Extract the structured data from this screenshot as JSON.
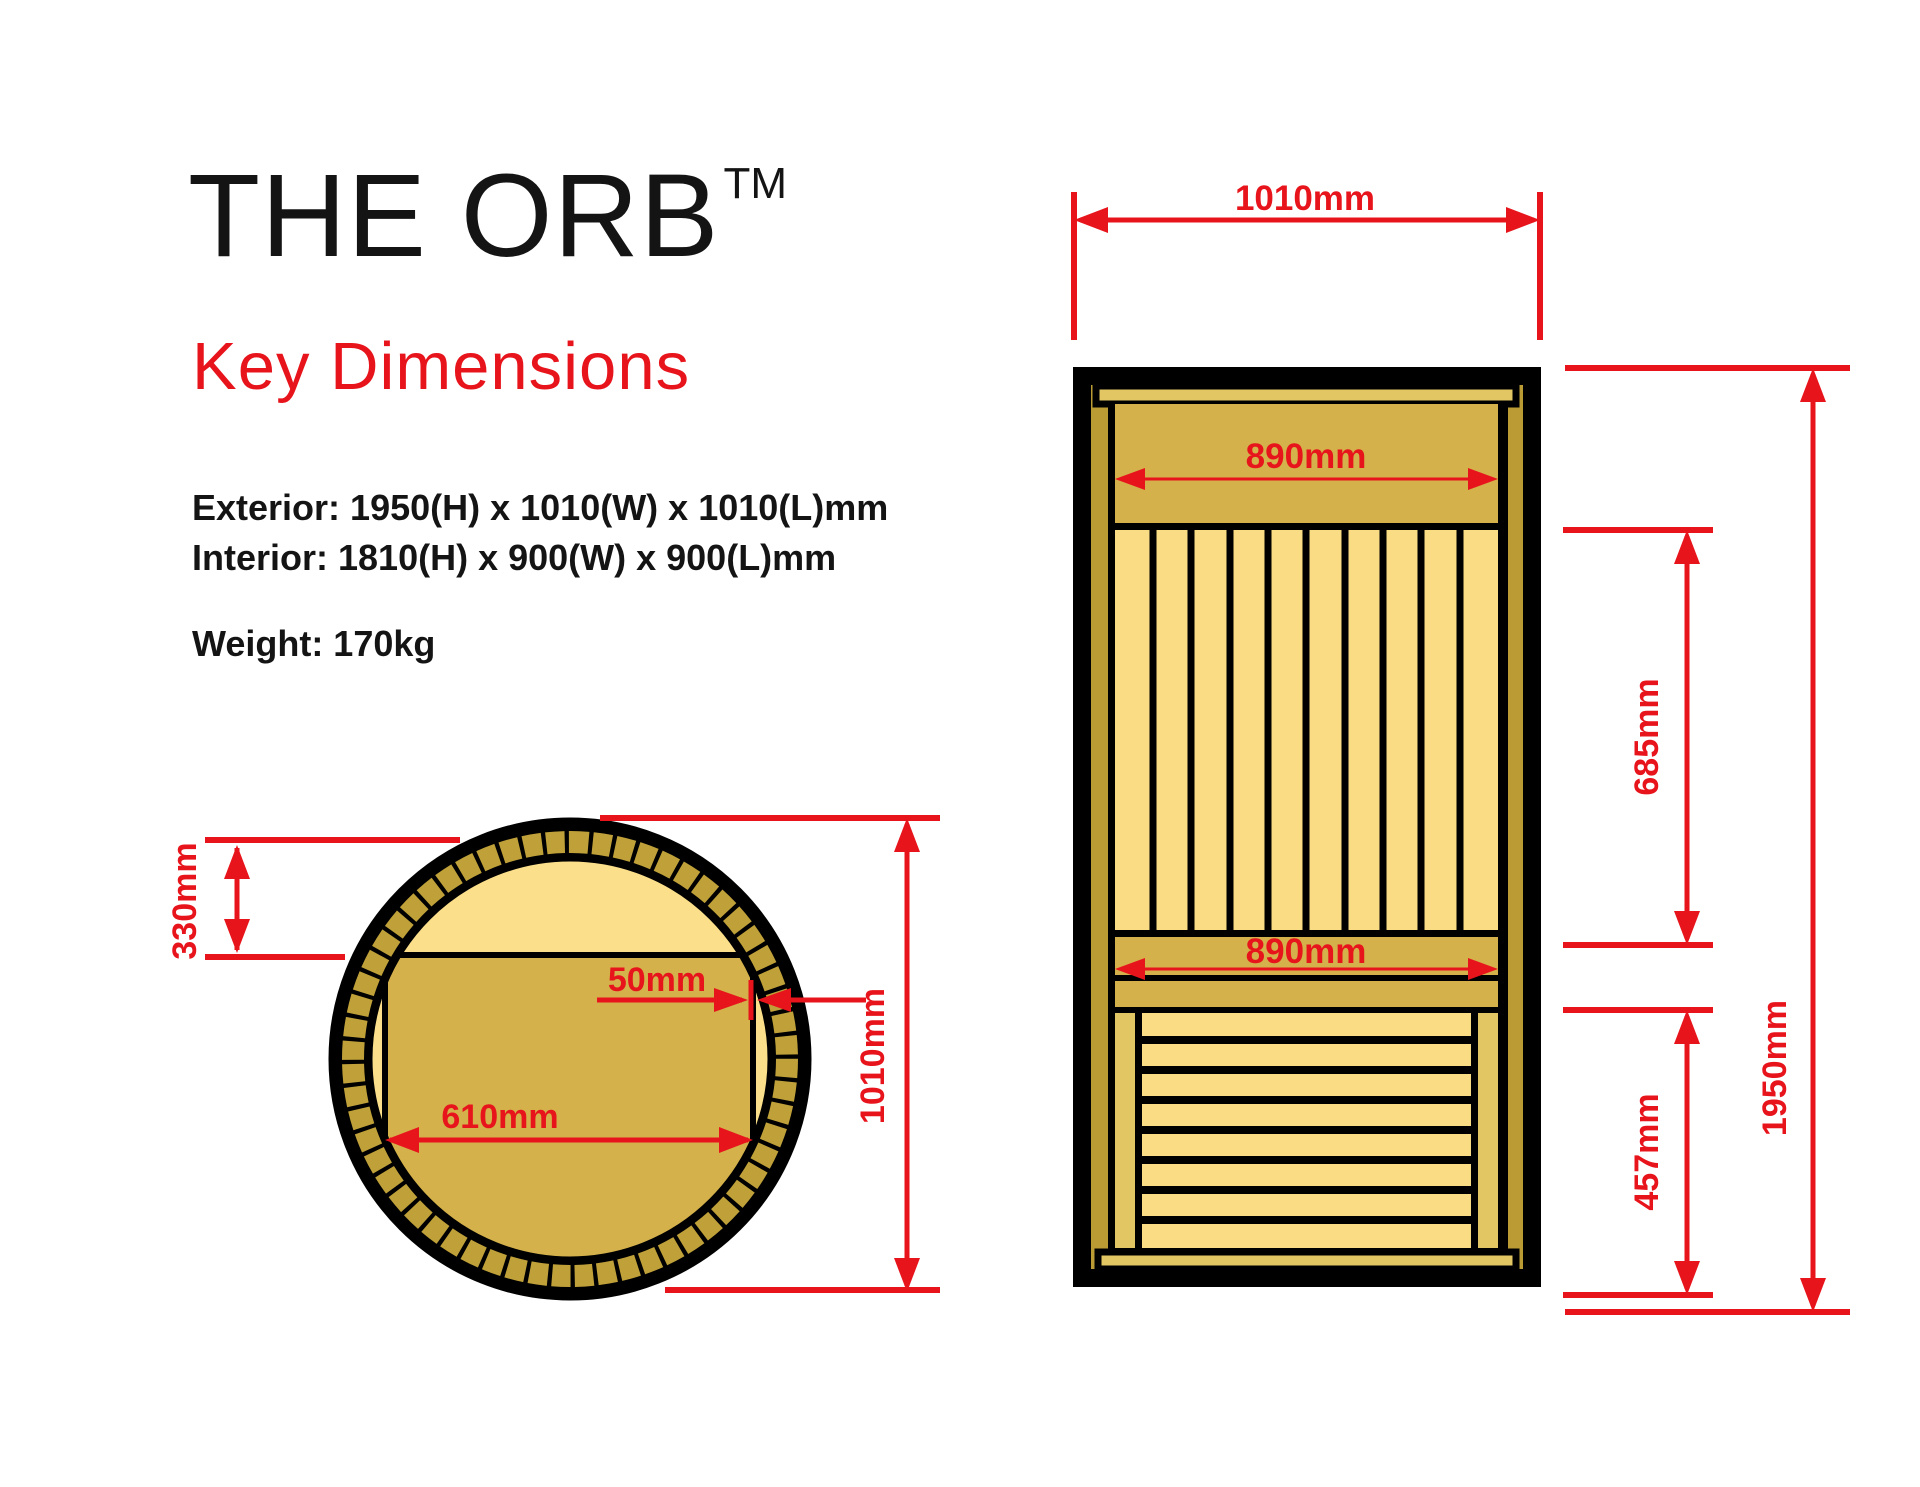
{
  "header": {
    "title": "THE ORB",
    "trademark": "TM",
    "subtitle": "Key Dimensions"
  },
  "specs": {
    "exterior": "Exterior: 1950(H) x 1010(W) x 1010(L)mm",
    "interior": "Interior: 1810(H) x 900(W) x 900(L)mm",
    "weight": "Weight: 170kg"
  },
  "colors": {
    "accent_red": "#E8141C",
    "text_black": "#141414",
    "outline_black": "#000000",
    "wood_frame_dark": "#BA9B34",
    "wood_panel_mid": "#D4B14A",
    "wood_slat_light": "#FADC85",
    "wood_interior_light": "#FBDF8B",
    "wood_trim_bar": "#E3C664",
    "rim_segment_gold": "#BFA039"
  },
  "top_view": {
    "name": "Top view cross-section",
    "dims": {
      "offset_330": "330mm",
      "gap_50": "50mm",
      "bench_width_610": "610mm",
      "diameter_1010": "1010mm"
    }
  },
  "front_view": {
    "name": "Front elevation",
    "dims": {
      "exterior_width_1010": "1010mm",
      "interior_width_top_890": "890mm",
      "interior_width_bench_890": "890mm",
      "interior_height_685": "685mm",
      "bench_height_457": "457mm",
      "exterior_height_1950": "1950mm"
    }
  }
}
